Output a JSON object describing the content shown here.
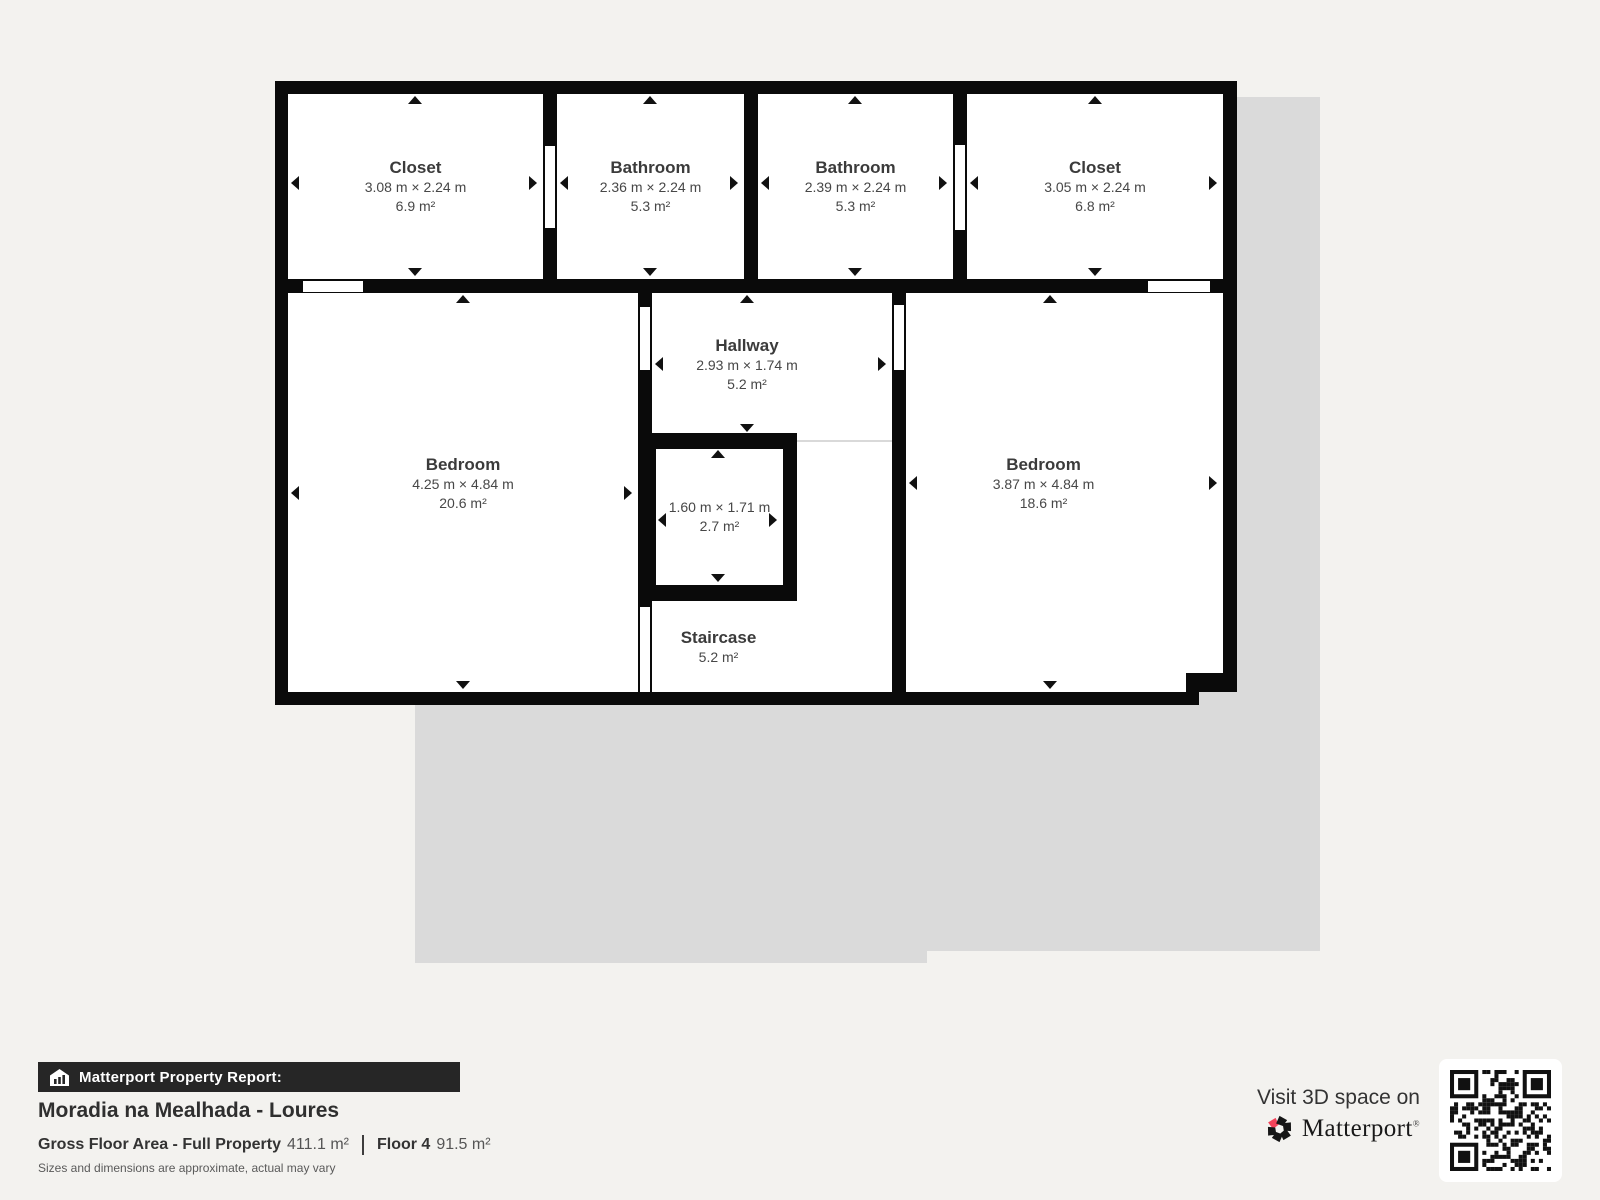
{
  "floorplan": {
    "rooms": [
      {
        "id": "closet-1",
        "name": "Closet",
        "dims": "3.08 m × 2.24 m",
        "area": "6.9 m²"
      },
      {
        "id": "bathroom-1",
        "name": "Bathroom",
        "dims": "2.36 m × 2.24 m",
        "area": "5.3 m²"
      },
      {
        "id": "bathroom-2",
        "name": "Bathroom",
        "dims": "2.39 m × 2.24 m",
        "area": "5.3 m²"
      },
      {
        "id": "closet-2",
        "name": "Closet",
        "dims": "3.05 m × 2.24 m",
        "area": "6.8 m²"
      },
      {
        "id": "bedroom-left",
        "name": "Bedroom",
        "dims": "4.25 m × 4.84 m",
        "area": "20.6 m²"
      },
      {
        "id": "hallway",
        "name": "Hallway",
        "dims": "2.93 m × 1.74 m",
        "area": "5.2 m²"
      },
      {
        "id": "small-room",
        "name": "",
        "dims": "1.60 m × 1.71 m",
        "area": "2.7 m²"
      },
      {
        "id": "staircase",
        "name": "Staircase",
        "dims": "",
        "area": "5.2 m²"
      },
      {
        "id": "bedroom-right",
        "name": "Bedroom",
        "dims": "3.87 m × 4.84 m",
        "area": "18.6 m²"
      }
    ]
  },
  "footer": {
    "report_label": "Matterport Property Report:",
    "property_title": "Moradia na Mealhada - Loures",
    "gross_label": "Gross Floor Area - Full Property",
    "gross_value": "411.1 m²",
    "floor_label": "Floor 4",
    "floor_value": "91.5 m²",
    "disclaimer": "Sizes and dimensions are approximate, actual may vary"
  },
  "cta": {
    "visit_text": "Visit 3D space on",
    "brand": "Matterport",
    "brand_mark": "®"
  },
  "colors": {
    "background": "#f3f2ef",
    "wall": "#0a0a0a",
    "other_floor_silhouette": "#dadada",
    "report_bar": "#262626",
    "brand_accent_red": "#f4435a"
  }
}
